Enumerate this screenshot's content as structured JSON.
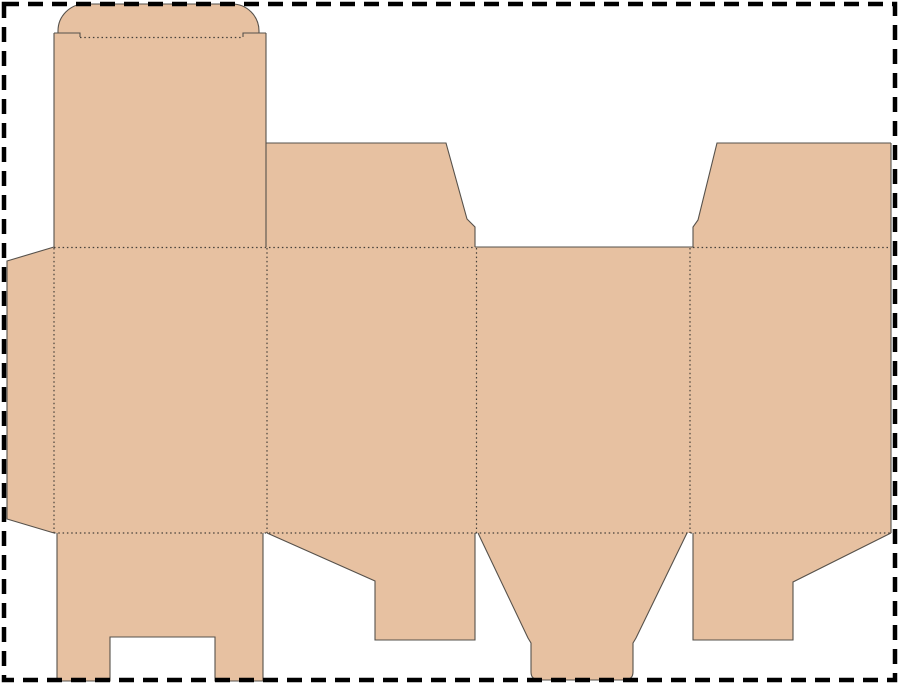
{
  "canvas": {
    "width": 900,
    "height": 685,
    "background_color": "#ffffff"
  },
  "colors": {
    "board_fill": "#e7c1a1",
    "cut_line": "#56514b",
    "fold_line": "#45403a",
    "sheet_border": "#000000"
  },
  "sheet_border": {
    "x": 4,
    "y": 4,
    "width": 891,
    "height": 676,
    "stroke_width": 4.5,
    "dash_pattern": "15 9"
  },
  "fold_line_style": {
    "stroke_width": 1.2,
    "dash_pattern": "1.5 2.8"
  },
  "cut_line_style": {
    "stroke_width": 1.1
  },
  "dieline": {
    "pieces": [
      {
        "name": "tuck-flap",
        "path": "M58,34 L58,31 A27,27 0 0 1 85,4 L232,4 A27,27 0 0 1 259,31 L259,34 L58,34 Z"
      },
      {
        "name": "lid-panel",
        "path": "M54,33 L266,33 L266,248 L54,248 Z"
      },
      {
        "name": "glue-flap",
        "path": "M7,261 L54,247 L54,533 L7,519 Z"
      },
      {
        "name": "main-panel-band",
        "path": "M54,247 L891,247 L891,533 L54,533 Z"
      },
      {
        "name": "dust-flap-top-left",
        "path": "M266,143 L446,143 L467,219 L475,227 L475,248 L266,248 Z"
      },
      {
        "name": "dust-flap-top-right",
        "path": "M717,143 L891,143 L891,248 L693,248 L693,227 L698,220 Z"
      },
      {
        "name": "bottom-flap-front",
        "path": "M57,533 L263,533 L263,681 L215,681 L215,637 L110,637 L110,681 L57,681 Z"
      },
      {
        "name": "bottom-flap-left",
        "path": "M267,533 L475,533 L475,640 L375,640 L375,581 Z"
      },
      {
        "name": "bottom-tuck-tongue",
        "path": "M478,533 L687,533 L636,638 L633,643 L633,672 Q633,680 624,680 L540,680 Q531,680 531,672 L531,643 L528,638 Z"
      },
      {
        "name": "bottom-flap-right",
        "path": "M693,533 L891,533 L793,582 L793,640 L693,640 Z"
      }
    ],
    "cut_lines": [
      {
        "name": "tuck-flap-outline",
        "path": "M58,33 L58,31 A27,27 0 0 1 85,4 L232,4 A27,27 0 0 1 259,31 L259,33"
      },
      {
        "name": "tuck-shoulder-left",
        "path": "M54,33 L80,33 L80,37"
      },
      {
        "name": "tuck-shoulder-right",
        "path": "M266,33 L243,33 L243,37"
      },
      {
        "name": "lid-panel-left-edge",
        "path": "M54,33 L54,247"
      },
      {
        "name": "lid-panel-right-edge",
        "path": "M266,33 L266,247"
      },
      {
        "name": "dust-flap-top-left-edge",
        "path": "M266,143 L446,143 L467,219 L475,227 L475,247"
      },
      {
        "name": "side-panel-top-edge",
        "path": "M475,247 L693,247"
      },
      {
        "name": "dust-flap-top-right-edge",
        "path": "M693,247 L693,227 L698,220 L717,143 L891,143"
      },
      {
        "name": "sheet-right-cut",
        "path": "M891,143 L891,533"
      },
      {
        "name": "glue-flap-edge",
        "path": "M54,247 L7,261 L7,519 L54,533"
      },
      {
        "name": "bottom-flap-front-edge",
        "path": "M57,533 L57,681 L110,681 L110,637 L215,637 L215,681 L263,681 L263,533"
      },
      {
        "name": "bottom-flap-left-edge",
        "path": "M267,533 L375,581 L375,640 L475,640 L475,533"
      },
      {
        "name": "bottom-tuck-tongue-edge",
        "path": "M478,533 L528,638 L531,643 L531,672 Q531,680 540,680 L624,680 Q633,680 633,672 L633,643 L636,638 L687,533"
      },
      {
        "name": "bottom-flap-right-edge",
        "path": "M693,533 L693,640 L793,640 L793,582 L891,533"
      }
    ],
    "fold_lines": [
      {
        "name": "tuck-fold",
        "path": "M80,37.5 L243,37.5"
      },
      {
        "name": "top-fold-left",
        "path": "M54,247.5 L475,247.5"
      },
      {
        "name": "top-fold-right",
        "path": "M693,247.5 L891,247.5"
      },
      {
        "name": "glue-flap-fold",
        "path": "M54,248 L54,533"
      },
      {
        "name": "panel-fold-1",
        "path": "M267,248 L267,533"
      },
      {
        "name": "panel-fold-2",
        "path": "M476.5,248 L476.5,533"
      },
      {
        "name": "panel-fold-3",
        "path": "M690,248 L690,533"
      },
      {
        "name": "bottom-fold",
        "path": "M54,533 L891,533"
      }
    ]
  }
}
